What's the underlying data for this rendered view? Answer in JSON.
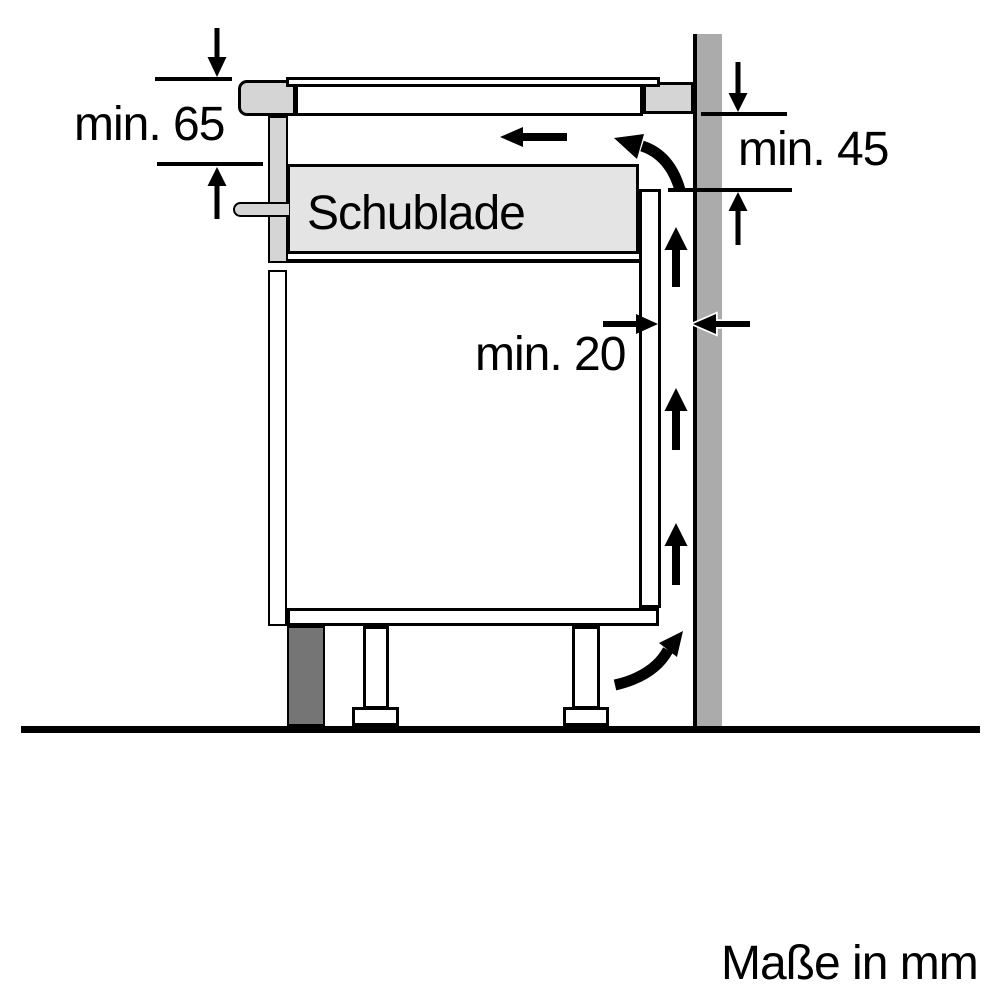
{
  "figure": {
    "drawer_label": "Schublade",
    "units_note": "Maße in mm",
    "dimensions": {
      "top_left": "min. 65",
      "right": "min. 45",
      "gap": "min. 20"
    },
    "arrow_semantics": {
      "dimension_arrows": "black triangular pointers on dimension lines",
      "airflow_arrows": "straight and curved black arrows showing ventilation air path behind cabinet and under hob"
    }
  },
  "colors": {
    "line": "#000000",
    "bg": "#ffffff",
    "wall": "#ababab",
    "panel": "#d5d5d5",
    "drawer": "#e4e4e4",
    "plinth": "#757575"
  }
}
